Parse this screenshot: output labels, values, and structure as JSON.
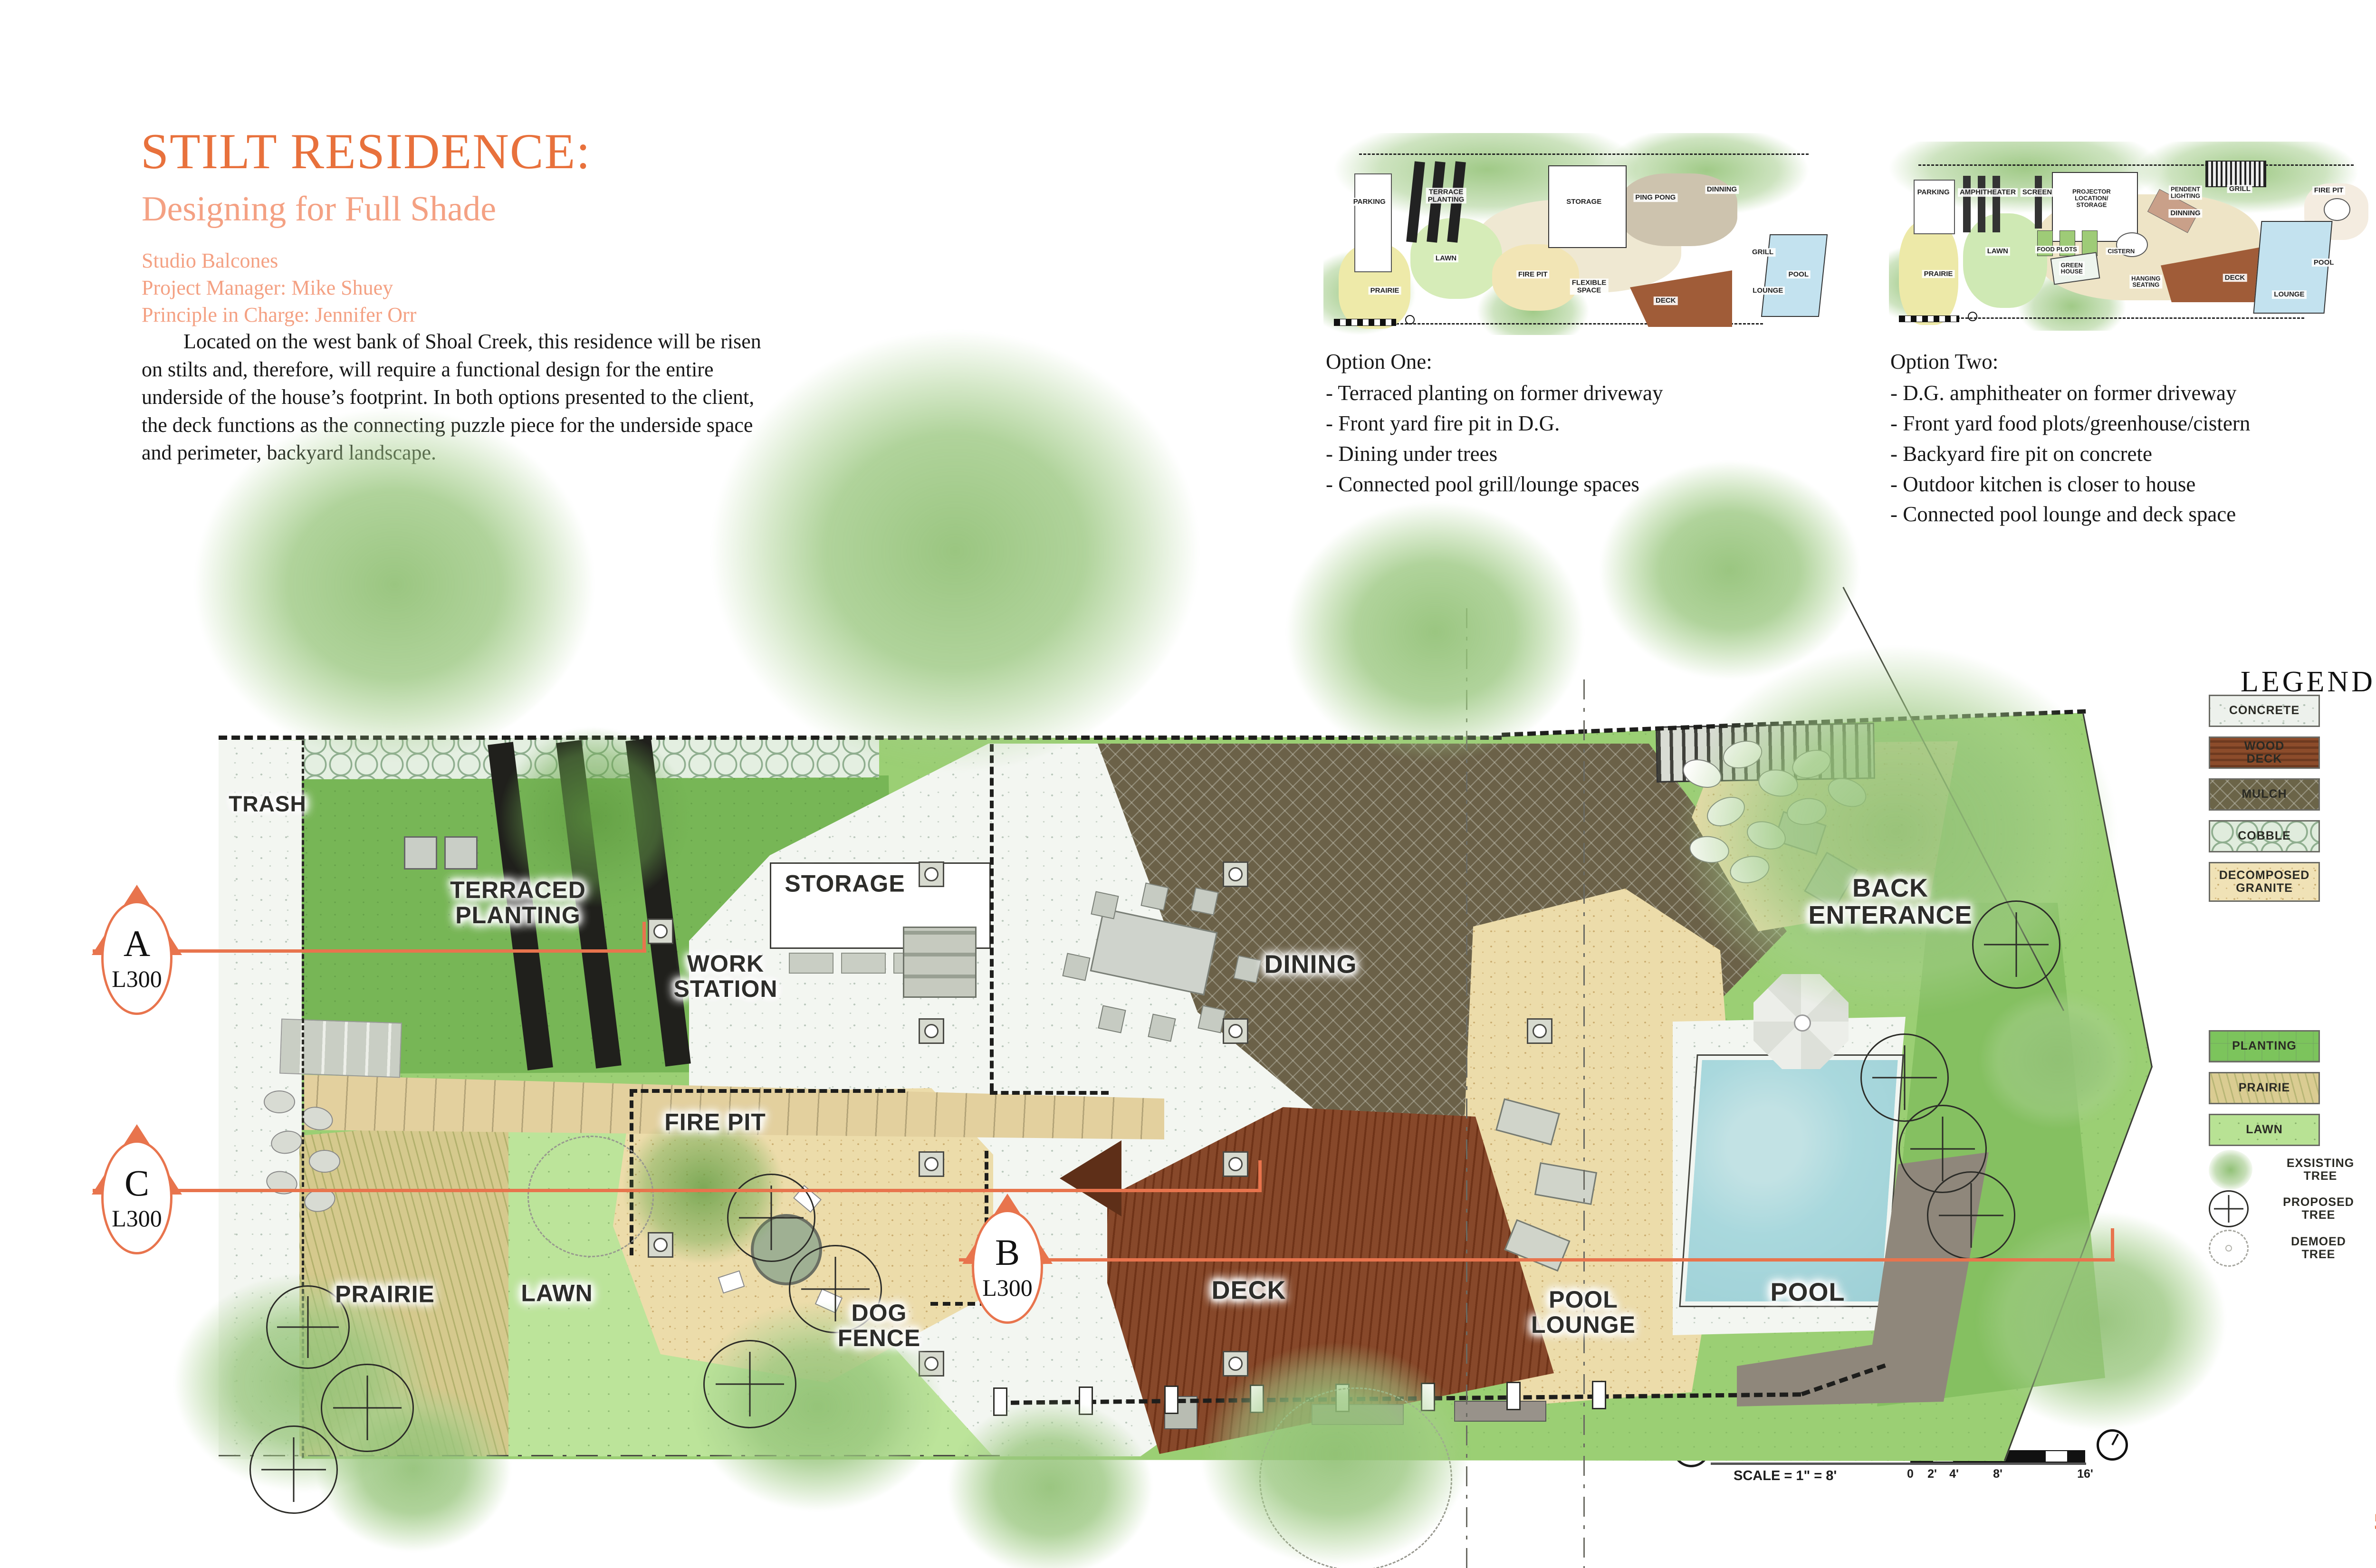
{
  "page": {
    "number": "5"
  },
  "header": {
    "title": "STILT RESIDENCE:",
    "subtitle": "Designing for Full Shade",
    "credits": [
      "Studio Balcones",
      "Project Manager: Mike Shuey",
      "Principle in Charge: Jennifer Orr"
    ],
    "paragraph": "Located on the west bank of Shoal Creek, this residence will be risen on stilts and, therefore, will require a functional design for the entire underside of the house’s footprint. In both options presented to the client, the deck functions as the connecting puzzle piece for the underside space and perimeter, backyard landscape."
  },
  "options": [
    {
      "heading": "Option One:",
      "items": [
        "- Terraced planting on former driveway",
        "- Front yard fire pit in D.G.",
        "- Dining under trees",
        "- Connected pool grill/lounge spaces"
      ],
      "thumb_labels": [
        "PARKING",
        "TERRACE\nPLANTING",
        "STORAGE",
        "PING PONG",
        "DINNING",
        "LAWN",
        "FIRE PIT",
        "PRAIRIE",
        "FLEXIBLE\nSPACE",
        "DECK",
        "GRILL",
        "LOUNGE",
        "POOL"
      ]
    },
    {
      "heading": "Option Two:",
      "items": [
        "- D.G. amphitheater on former driveway",
        "- Front yard food plots/greenhouse/cistern",
        "- Backyard fire pit on concrete",
        "- Outdoor kitchen is closer to house",
        "- Connected pool lounge and deck space"
      ],
      "thumb_labels": [
        "PARKING",
        "AMPHITHEATER",
        "SCREEN",
        "PROJECTOR\nLOCATION/\nSTORAGE",
        "PENDENT\nLIGHTING",
        "GRILL",
        "DINNING",
        "FIRE PIT",
        "LAWN",
        "FOOD PLOTS",
        "CISTERN",
        "GREEN\nHOUSE",
        "PRAIRIE",
        "HANGING\nSEATING",
        "DECK",
        "LOUNGE",
        "POOL"
      ]
    }
  ],
  "plan": {
    "labels": [
      {
        "text": "TRASH"
      },
      {
        "text": "TERRACED\nPLANTING"
      },
      {
        "text": "STORAGE"
      },
      {
        "text": "WORK\nSTATION"
      },
      {
        "text": "DINING"
      },
      {
        "text": "BACK\nENTERANCE"
      },
      {
        "text": "FIRE PIT"
      },
      {
        "text": "DOG\nFENCE"
      },
      {
        "text": "PRAIRIE"
      },
      {
        "text": "LAWN"
      },
      {
        "text": "DECK"
      },
      {
        "text": "POOL\nLOUNGE"
      },
      {
        "text": "POOL"
      }
    ],
    "markers": [
      {
        "letter": "A",
        "sheet": "L300"
      },
      {
        "letter": "C",
        "sheet": "L300"
      },
      {
        "letter": "B",
        "sheet": "L300"
      }
    ]
  },
  "legend": {
    "title": "LEGEND",
    "materials": [
      {
        "label": "CONCRETE"
      },
      {
        "label": "WOOD\nDECK"
      },
      {
        "label": "MULCH"
      },
      {
        "label": "COBBLE"
      },
      {
        "label": "DECOMPOSED\nGRANITE"
      },
      {
        "label": "PLANTING"
      },
      {
        "label": "PRAIRIE"
      },
      {
        "label": "LAWN"
      }
    ],
    "trees": [
      {
        "label": "EXSISTING\nTREE"
      },
      {
        "label": "PROPOSED\nTREE"
      },
      {
        "label": "DEMOED\nTREE"
      }
    ]
  },
  "titleblock": {
    "number": "1",
    "name": "OVERALL SITE PLAN",
    "scale": "SCALE = 1\" = 8'",
    "ticks": [
      "0",
      "2'",
      "4'",
      "8'",
      "16'"
    ]
  },
  "colors": {
    "accent_orange": "#E8713C",
    "salmon": "#F4A183",
    "section_line": "#E8744D",
    "pool_water": "#A9D8DD",
    "deck_brown": "#7C3F23",
    "mulch": "#6B6148",
    "dg_tan": "#ECDCAA",
    "planting_green": "#9BCF74",
    "lawn_green": "#BCE49A",
    "prairie_tan": "#D5C98D"
  }
}
